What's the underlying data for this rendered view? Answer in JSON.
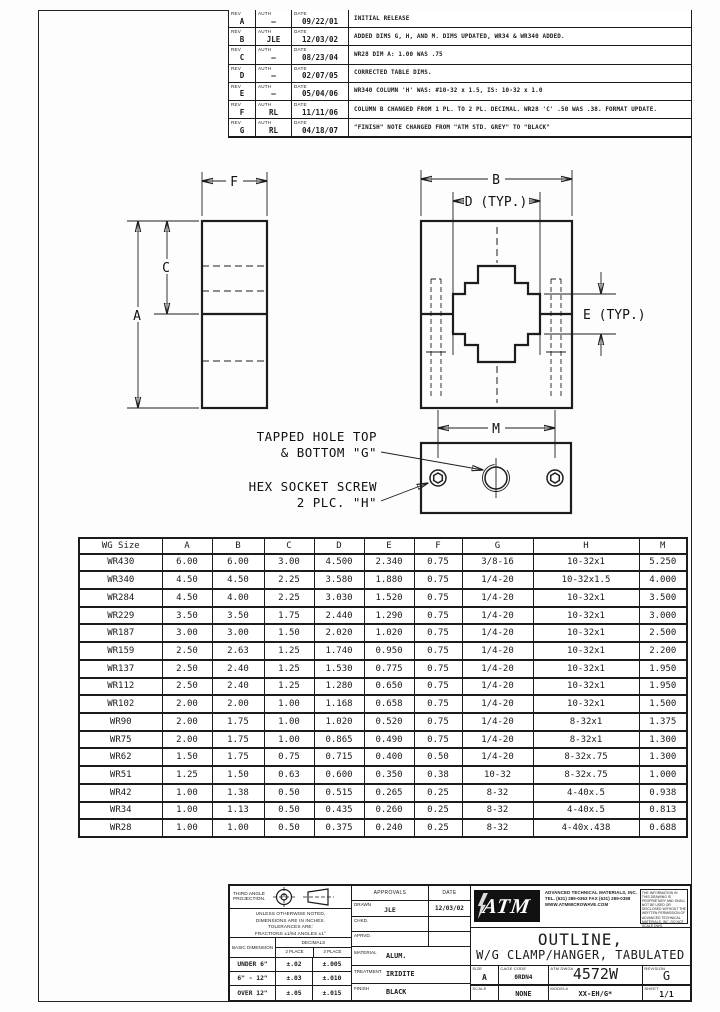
{
  "rev_labels": {
    "rev": "REV",
    "auth": "AUTH",
    "date": "DATE"
  },
  "revisions": [
    {
      "rev": "A",
      "auth": "—",
      "date": "09/22/01",
      "desc": "INITIAL RELEASE"
    },
    {
      "rev": "B",
      "auth": "JLE",
      "date": "12/03/02",
      "desc": "ADDED DIMS G, H, AND M.  DIMS UPDATED, WR34 & WR340 ADDED."
    },
    {
      "rev": "C",
      "auth": "—",
      "date": "08/23/04",
      "desc": "WR28 DIM A: 1.00 WAS .75"
    },
    {
      "rev": "D",
      "auth": "—",
      "date": "02/07/05",
      "desc": "CORRECTED TABLE DIMS."
    },
    {
      "rev": "E",
      "auth": "—",
      "date": "05/04/06",
      "desc": "WR340 COLUMN 'H' WAS: #10-32 x 1.5, IS: 10-32 x 1.0"
    },
    {
      "rev": "F",
      "auth": "RL",
      "date": "11/11/06",
      "desc": "COLUMN B CHANGED FROM 1 PL. TO 2 PL. DECIMAL.  WR28 'C' .50 WAS .38.  FORMAT UPDATE."
    },
    {
      "rev": "G",
      "auth": "RL",
      "date": "04/18/07",
      "desc": "\"FINISH\" NOTE CHANGED FROM \"ATM STD. GREY\" TO \"BLACK\""
    }
  ],
  "drawing": {
    "dims": {
      "A": "A",
      "B": "B",
      "C": "C",
      "D": "D (TYP.)",
      "E": "E (TYP.)",
      "F": "F",
      "M": "M"
    },
    "notes": {
      "tapped_line1": "TAPPED HOLE TOP",
      "tapped_line2": "& BOTTOM \"G\"",
      "hex_line1": "HEX SOCKET SCREW",
      "hex_line2": "2 PLC. \"H\""
    }
  },
  "table": {
    "headers": [
      "WG Size",
      "A",
      "B",
      "C",
      "D",
      "E",
      "F",
      "G",
      "H",
      "M"
    ],
    "rows": [
      [
        "WR430",
        "6.00",
        "6.00",
        "3.00",
        "4.500",
        "2.340",
        "0.75",
        "3/8-16",
        "10-32x1",
        "5.250"
      ],
      [
        "WR340",
        "4.50",
        "4.50",
        "2.25",
        "3.580",
        "1.880",
        "0.75",
        "1/4-20",
        "10-32x1.5",
        "4.000"
      ],
      [
        "WR284",
        "4.50",
        "4.00",
        "2.25",
        "3.030",
        "1.520",
        "0.75",
        "1/4-20",
        "10-32x1",
        "3.500"
      ],
      [
        "WR229",
        "3.50",
        "3.50",
        "1.75",
        "2.440",
        "1.290",
        "0.75",
        "1/4-20",
        "10-32x1",
        "3.000"
      ],
      [
        "WR187",
        "3.00",
        "3.00",
        "1.50",
        "2.020",
        "1.020",
        "0.75",
        "1/4-20",
        "10-32x1",
        "2.500"
      ],
      [
        "WR159",
        "2.50",
        "2.63",
        "1.25",
        "1.740",
        "0.950",
        "0.75",
        "1/4-20",
        "10-32x1",
        "2.200"
      ],
      [
        "WR137",
        "2.50",
        "2.40",
        "1.25",
        "1.530",
        "0.775",
        "0.75",
        "1/4-20",
        "10-32x1",
        "1.950"
      ],
      [
        "WR112",
        "2.50",
        "2.40",
        "1.25",
        "1.280",
        "0.650",
        "0.75",
        "1/4-20",
        "10-32x1",
        "1.950"
      ],
      [
        "WR102",
        "2.00",
        "2.00",
        "1.00",
        "1.168",
        "0.658",
        "0.75",
        "1/4-20",
        "10-32x1",
        "1.500"
      ],
      [
        "WR90",
        "2.00",
        "1.75",
        "1.00",
        "1.020",
        "0.520",
        "0.75",
        "1/4-20",
        "8-32x1",
        "1.375"
      ],
      [
        "WR75",
        "2.00",
        "1.75",
        "1.00",
        "0.865",
        "0.490",
        "0.75",
        "1/4-20",
        "8-32x1",
        "1.300"
      ],
      [
        "WR62",
        "1.50",
        "1.75",
        "0.75",
        "0.715",
        "0.400",
        "0.50",
        "1/4-20",
        "8-32x.75",
        "1.300"
      ],
      [
        "WR51",
        "1.25",
        "1.50",
        "0.63",
        "0.600",
        "0.350",
        "0.38",
        "10-32",
        "8-32x.75",
        "1.000"
      ],
      [
        "WR42",
        "1.00",
        "1.38",
        "0.50",
        "0.515",
        "0.265",
        "0.25",
        "8-32",
        "4-40x.5",
        "0.938"
      ],
      [
        "WR34",
        "1.00",
        "1.13",
        "0.50",
        "0.435",
        "0.260",
        "0.25",
        "8-32",
        "4-40x.5",
        "0.813"
      ],
      [
        "WR28",
        "1.00",
        "1.00",
        "0.50",
        "0.375",
        "0.240",
        "0.25",
        "8-32",
        "4-40x.438",
        "0.688"
      ]
    ]
  },
  "titleblock": {
    "projection_label": "THIRD ANGLE PROJECTION.",
    "tolerance_notes": [
      "UNLESS OTHERWISE NOTED,",
      "DIMENSIONS ARE IN INCHES.",
      "TOLERANCES ARE:",
      "FRACTIONS ±1/64   ANGLES ±1°"
    ],
    "tol_table": {
      "col1_header": "BASIC DIMENSION",
      "col2_header": "DECIMALS",
      "sub2": "2 PLACE",
      "sub3": "3 PLACE",
      "rows": [
        [
          "UNDER 6\"",
          "±.02",
          "±.005"
        ],
        [
          "6\" - 12\"",
          "±.03",
          "±.010"
        ],
        [
          "OVER 12\"",
          "±.05",
          "±.015"
        ]
      ]
    },
    "approvals": {
      "header": "APPROVALS",
      "date_header": "DATE",
      "rows": [
        {
          "label": "DRAWN",
          "value": "JLE",
          "date": "12/03/02"
        },
        {
          "label": "CHKD.",
          "value": "",
          "date": ""
        },
        {
          "label": "APRVD.",
          "value": "",
          "date": ""
        }
      ]
    },
    "material": {
      "label": "MATERIAL",
      "value": "ALUM."
    },
    "treatment": {
      "label": "TREATMENT",
      "value": "IRIDITE"
    },
    "finish": {
      "label": "FINISH",
      "value": "BLACK"
    },
    "company": {
      "logo_text": "ATM",
      "name": "ADVANCED TECHNICAL MATERIALS, INC.",
      "tel": "TEL. (631) 289-0363  FAX (631) 289-0358",
      "web": "WWW.ATMMICROWAVE.COM"
    },
    "proprietary": "THE INFORMATION IN THIS DRAWING IS PROPRIETARY AND SHALL NOT BE USED OR DISCLOSED WITHOUT THE WRITTEN PERMISSION OF ADVANCED TECHNICAL MATERIALS, INC.  DO NOT SCALE DWG.",
    "title_line1": "OUTLINE,",
    "title_line2": "W/G CLAMP/HANGER, TABULATED",
    "size": {
      "label": "SIZE",
      "value": "A"
    },
    "cage": {
      "label": "CAGE CODE",
      "value": "0RDN4"
    },
    "dwg": {
      "label": "ATM DWG#",
      "value": "4572W"
    },
    "revision": {
      "label": "REVISION",
      "value": "G"
    },
    "scale": {
      "label": "SCALE",
      "value": "NONE"
    },
    "model": {
      "label": "MODEL#",
      "value": "XX-EH/G*"
    },
    "sheet": {
      "label": "SHEET",
      "value": "1/1"
    }
  }
}
